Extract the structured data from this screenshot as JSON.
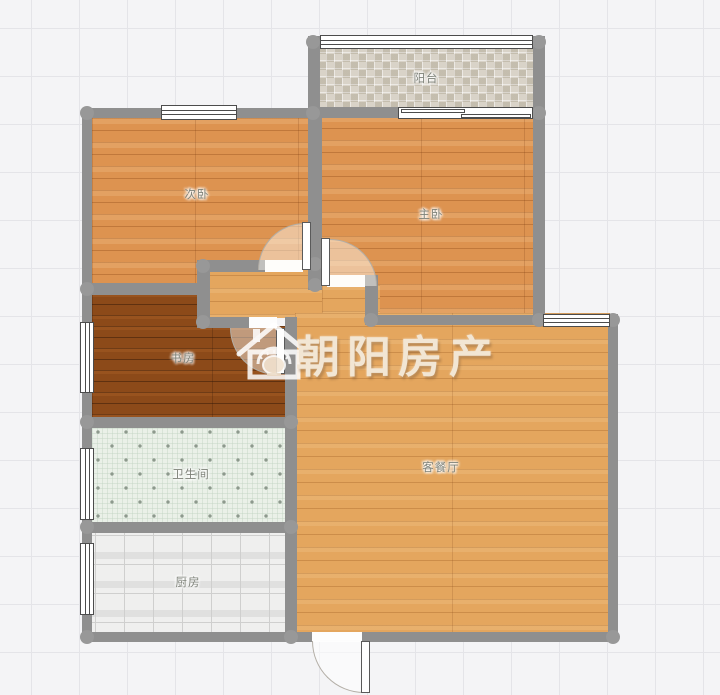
{
  "canvas": {
    "width": 720,
    "height": 695
  },
  "colors": {
    "background": "#f4f4f6",
    "grid_line": "#e4e4e8",
    "wall": "#8f8f8f",
    "wood_orange": "#dd9350",
    "wood_light": "#e4a65e",
    "wood_dark": "#8c4a19",
    "tile_balcony": "#cfc8ba",
    "tile_bath": "#eaf0e8",
    "tile_kitchen": "#e8e8e7",
    "watermark_text_color": "#f2e6d4"
  },
  "rooms": [
    {
      "id": "balcony",
      "label": "阳台",
      "floor": "mosaic-tile"
    },
    {
      "id": "bedroom2",
      "label": "次卧",
      "floor": "orange-wood"
    },
    {
      "id": "master",
      "label": "主卧",
      "floor": "orange-wood"
    },
    {
      "id": "study",
      "label": "书房",
      "floor": "dark-wood"
    },
    {
      "id": "bathroom",
      "label": "卫生间",
      "floor": "mint-dot-tile"
    },
    {
      "id": "kitchen",
      "label": "厨房",
      "floor": "gray-tile"
    },
    {
      "id": "living",
      "label": "客餐厅",
      "floor": "light-oak-wood"
    }
  ],
  "watermark": {
    "brand": "朝阳房产",
    "logo": "house-sun-logo"
  }
}
